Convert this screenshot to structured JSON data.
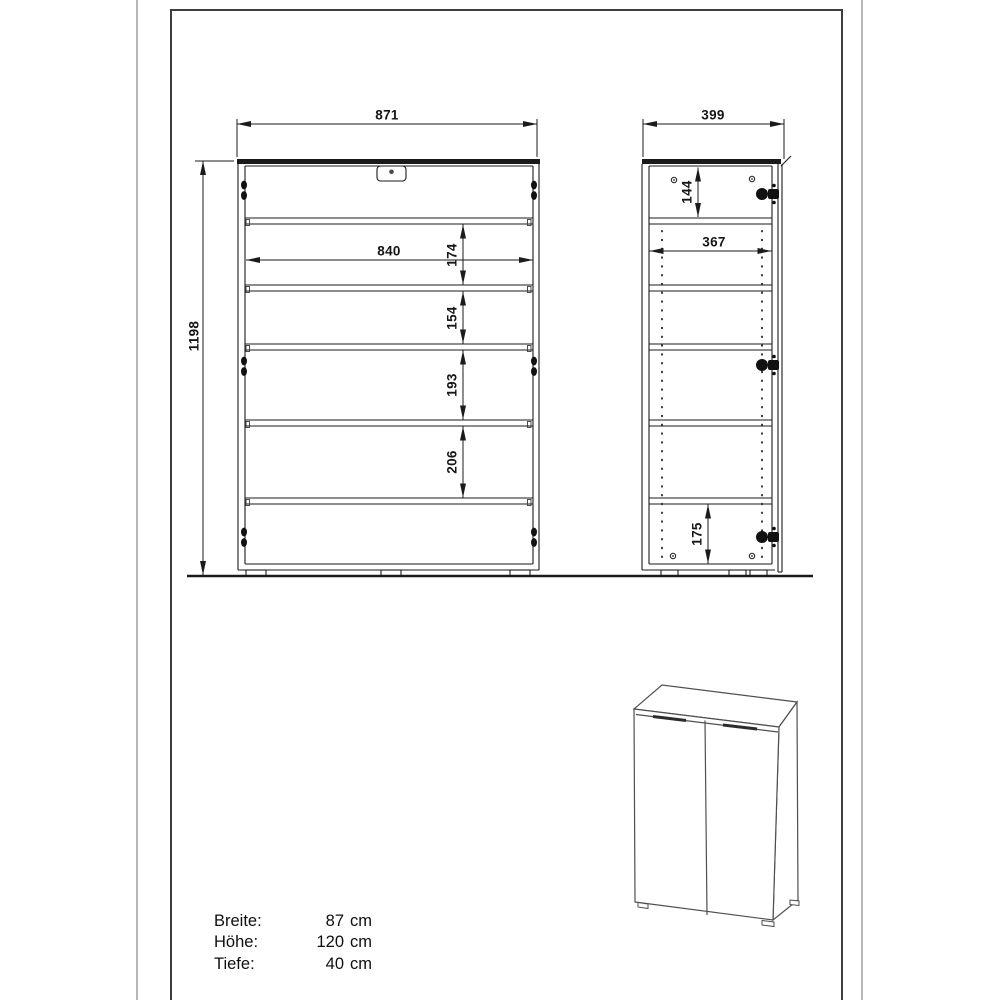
{
  "colors": {
    "line": "#1b1b1b",
    "frame": "#3d3d3d",
    "photo_edge": "#b7b7b7",
    "iso_line": "#4f4f4f"
  },
  "front_view": {
    "width": "871",
    "height": "1198",
    "inner_width": "840",
    "compartments": [
      "174",
      "154",
      "193",
      "206"
    ]
  },
  "side_view": {
    "depth": "399",
    "top_compartment": "144",
    "inner_depth": "367",
    "bottom_compartment": "175"
  },
  "specs": {
    "rows": [
      {
        "label": "Breite:",
        "value": "87",
        "unit": "cm"
      },
      {
        "label": "Höhe:",
        "value": "120",
        "unit": "cm"
      },
      {
        "label": "Tiefe:",
        "value": "40",
        "unit": "cm"
      }
    ]
  }
}
